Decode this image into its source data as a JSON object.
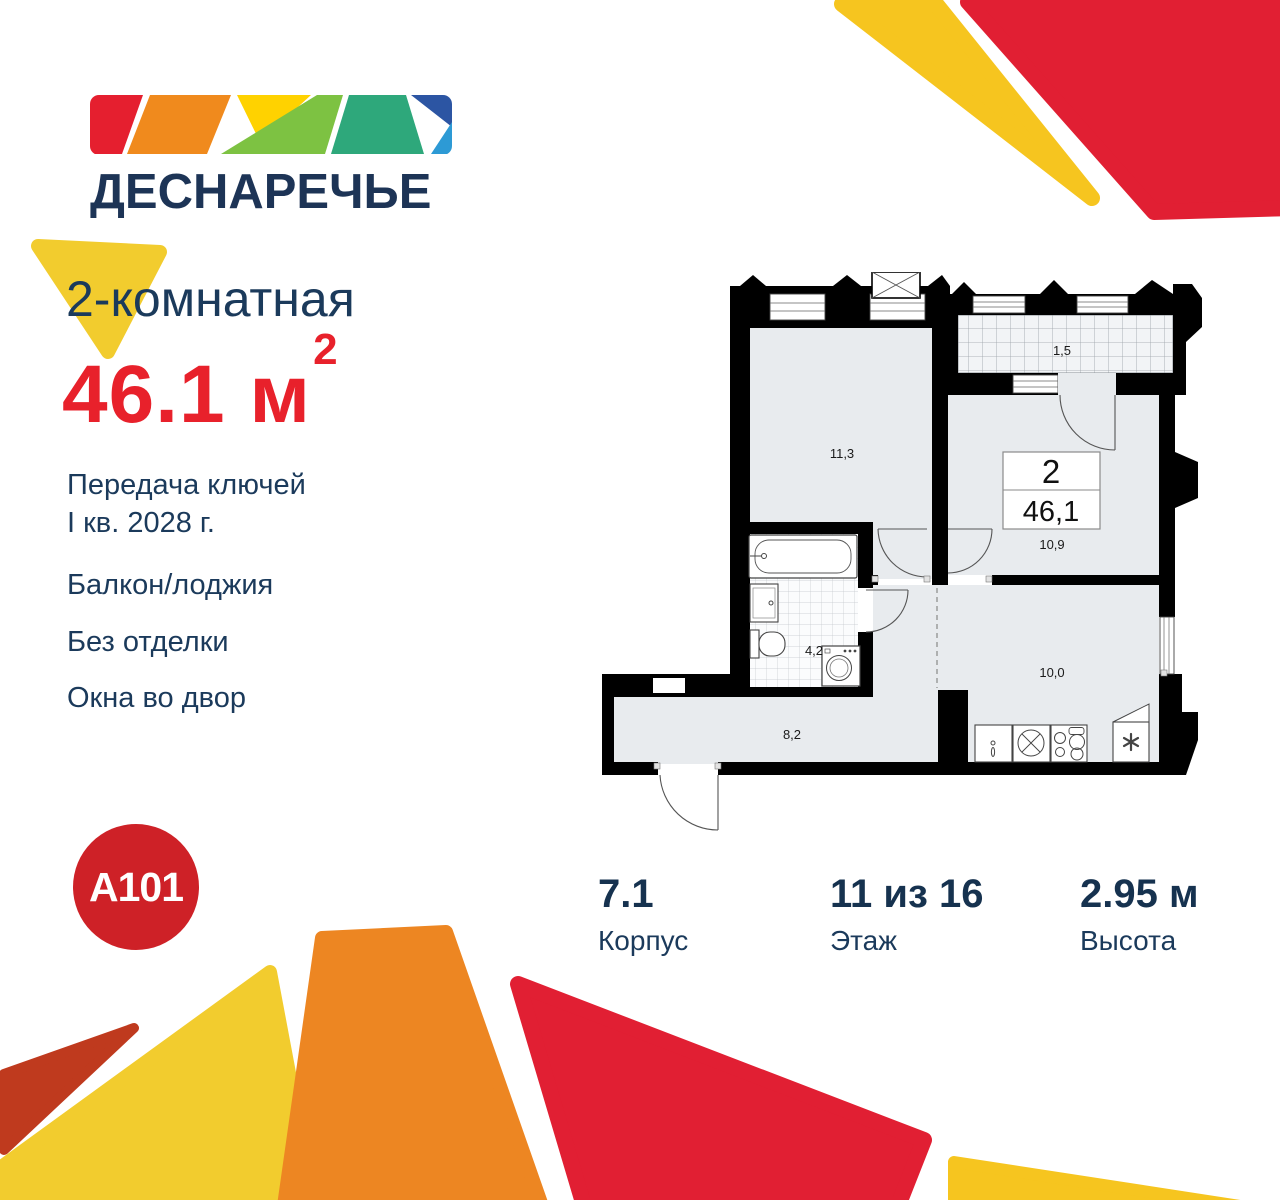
{
  "logo": {
    "name": "ДЕСНАРЕЧЬЕ"
  },
  "listing": {
    "type": "2-комнатная",
    "area_value": "46.1",
    "area_unit": "м",
    "area_sup": "2",
    "features": {
      "handover_line1": "Передача ключей",
      "handover_line2": "I кв. 2028 г.",
      "balcony": "Балкон/лоджия",
      "finish": "Без отделки",
      "windows": "Окна во двор"
    }
  },
  "developer": {
    "brand": "A101"
  },
  "stats": [
    {
      "value": "7.1",
      "label": "Корпус"
    },
    {
      "value": "11 из 16",
      "label": "Этаж"
    },
    {
      "value": "2.95 м",
      "label": "Высота"
    }
  ],
  "floor_plan": {
    "info_box": {
      "rooms": "2",
      "area": "46,1"
    },
    "room_areas": {
      "bedroom": "11,3",
      "balcony": "1,5",
      "living": "10,9",
      "bathroom": "4,2",
      "kitchen": "10,0",
      "hallway": "8,2"
    }
  },
  "colors": {
    "navy_text": "#1B3A5B",
    "area_red": "#E8212B",
    "brand_circle_red": "#CE2127",
    "decor_red": "#E11F33",
    "decor_orange": "#ED8622",
    "decor_yellow": "#F2CC2E",
    "decor_gold": "#F6C51F",
    "decor_brick": "#BF3A1E",
    "plan_floor": "#E8EBEE",
    "logo_mosaic": [
      "#E51F2F",
      "#F08A1D",
      "#FFD200",
      "#7DC242",
      "#2EA87B",
      "#2C55A3",
      "#2D9AD5"
    ]
  }
}
